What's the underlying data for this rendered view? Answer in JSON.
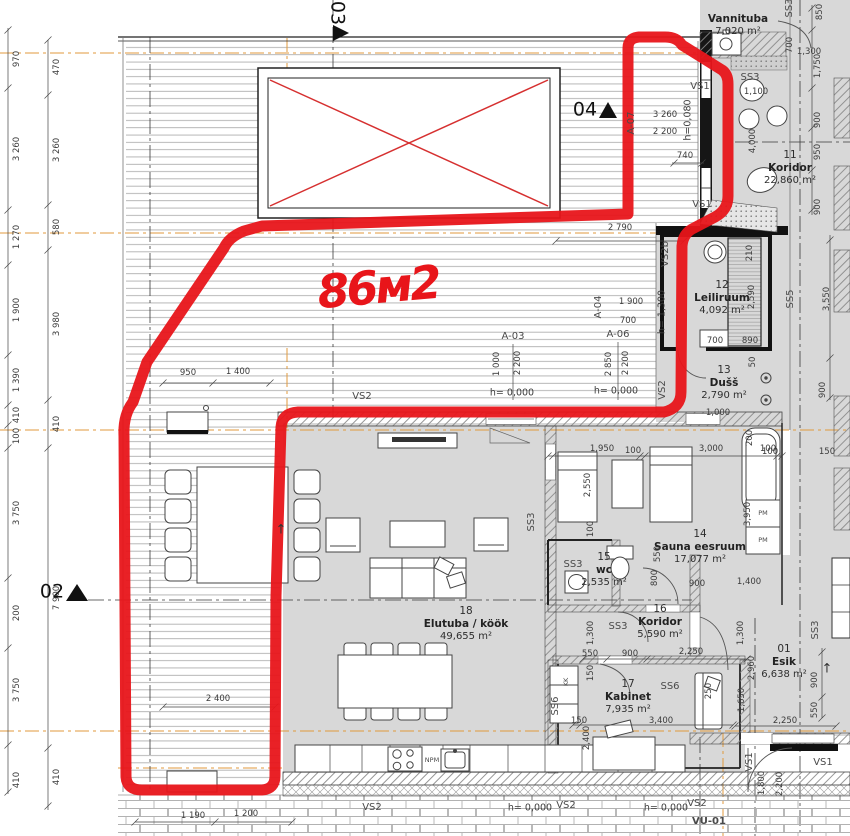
{
  "annotation": {
    "text": "86м2",
    "x": 378,
    "y": 287,
    "rot": -5,
    "size": 46,
    "color": "#e8151a"
  },
  "rooms": [
    {
      "num": "",
      "name": "Vannituba",
      "area": "7,020 m²",
      "x": 738,
      "y": 19
    },
    {
      "num": "11",
      "name": "Koridor",
      "area": "22,860 m²",
      "x": 790,
      "y": 168
    },
    {
      "num": "12",
      "name": "Leiliruum",
      "area": "4,092 m²",
      "x": 722,
      "y": 298
    },
    {
      "num": "13",
      "name": "Dušš",
      "area": "2,790 m²",
      "x": 724,
      "y": 383
    },
    {
      "num": "14",
      "name": "Sauna eesruum",
      "area": "17,077 m²",
      "x": 700,
      "y": 547
    },
    {
      "num": "15",
      "name": "wc",
      "area": "2,535 m²",
      "x": 604,
      "y": 570
    },
    {
      "num": "16",
      "name": "Koridor",
      "area": "5,590 m²",
      "x": 660,
      "y": 622
    },
    {
      "num": "17",
      "name": "Kabinet",
      "area": "7,935 m²",
      "x": 628,
      "y": 697
    },
    {
      "num": "18",
      "name": "Elutuba / köök",
      "area": "49,655 m²",
      "x": 466,
      "y": 624
    },
    {
      "num": "01",
      "name": "Esik",
      "area": "6,638 m²",
      "x": 784,
      "y": 662
    }
  ],
  "section_markers": [
    {
      "label": "02",
      "x": 52,
      "y": 592,
      "rot": 0
    },
    {
      "label": "03",
      "x": 337,
      "y": 13,
      "rot": 90
    },
    {
      "label": "04",
      "x": 585,
      "y": 110,
      "rot": 0
    }
  ],
  "wall_tags": [
    {
      "t": "VS1",
      "x": 700,
      "y": 87
    },
    {
      "t": "VS1",
      "x": 702,
      "y": 205
    },
    {
      "t": "VS2b",
      "x": 666,
      "y": 254,
      "r": -90
    },
    {
      "t": "VS2",
      "x": 663,
      "y": 390,
      "r": -90
    },
    {
      "t": "VS2",
      "x": 362,
      "y": 397
    },
    {
      "t": "VS2",
      "x": 372,
      "y": 808
    },
    {
      "t": "VS2",
      "x": 566,
      "y": 806
    },
    {
      "t": "VS2",
      "x": 697,
      "y": 804
    },
    {
      "t": "VS1",
      "x": 750,
      "y": 762,
      "r": -90
    },
    {
      "t": "VS1",
      "x": 823,
      "y": 763
    },
    {
      "t": "SS3",
      "x": 750,
      "y": 78
    },
    {
      "t": "SS3",
      "x": 790,
      "y": 8,
      "r": -90
    },
    {
      "t": "SS3",
      "x": 573,
      "y": 565
    },
    {
      "t": "SS3",
      "x": 618,
      "y": 627
    },
    {
      "t": "SS3",
      "x": 816,
      "y": 630,
      "r": -90
    },
    {
      "t": "SS3",
      "x": 532,
      "y": 522,
      "r": -90
    },
    {
      "t": "SS5",
      "x": 791,
      "y": 299,
      "r": -90
    },
    {
      "t": "SS6",
      "x": 670,
      "y": 687
    },
    {
      "t": "SS6",
      "x": 556,
      "y": 706,
      "r": -90
    },
    {
      "t": "KK",
      "x": 566,
      "y": 682,
      "r": -90,
      "s": 6.5
    },
    {
      "t": "PM",
      "x": 763,
      "y": 513,
      "s": 6.5
    },
    {
      "t": "PM",
      "x": 763,
      "y": 540,
      "s": 6.5
    },
    {
      "t": "NPM",
      "x": 432,
      "y": 760,
      "s": 6.5
    },
    {
      "t": "VU-01",
      "x": 709,
      "y": 822,
      "s": 10,
      "w": 700
    },
    {
      "t": "A-07",
      "x": 632,
      "y": 123,
      "r": -90
    },
    {
      "t": "A-03",
      "x": 513,
      "y": 337
    },
    {
      "t": "A-04",
      "x": 599,
      "y": 307,
      "r": -90
    },
    {
      "t": "A-06",
      "x": 618,
      "y": 335
    }
  ],
  "levels": [
    {
      "t": "h= 0,000",
      "x": 512,
      "y": 393
    },
    {
      "t": "h= 0,000",
      "x": 616,
      "y": 391
    },
    {
      "t": "h= 1,300",
      "x": 662,
      "y": 312,
      "r": -90
    },
    {
      "t": "h=0,080",
      "x": 688,
      "y": 120,
      "r": -90
    },
    {
      "t": "h= 0,000",
      "x": 530,
      "y": 808
    },
    {
      "t": "h= 0,000",
      "x": 666,
      "y": 808
    }
  ],
  "dimensions": [
    {
      "t": "970",
      "x": 17,
      "y": 59,
      "r": -90
    },
    {
      "t": "3 260",
      "x": 17,
      "y": 149,
      "r": -90
    },
    {
      "t": "1 270",
      "x": 17,
      "y": 237,
      "r": -90
    },
    {
      "t": "1 900",
      "x": 17,
      "y": 310,
      "r": -90
    },
    {
      "t": "1 390",
      "x": 17,
      "y": 380,
      "r": -90
    },
    {
      "t": "410",
      "x": 17,
      "y": 415,
      "r": -90
    },
    {
      "t": "100",
      "x": 17,
      "y": 436,
      "r": -90
    },
    {
      "t": "3 750",
      "x": 17,
      "y": 513,
      "r": -90
    },
    {
      "t": "200",
      "x": 17,
      "y": 613,
      "r": -90
    },
    {
      "t": "3 750",
      "x": 17,
      "y": 690,
      "r": -90
    },
    {
      "t": "410",
      "x": 17,
      "y": 780,
      "r": -90
    },
    {
      "t": "470",
      "x": 57,
      "y": 67,
      "r": -90
    },
    {
      "t": "3 260",
      "x": 57,
      "y": 150,
      "r": -90
    },
    {
      "t": "580",
      "x": 57,
      "y": 227,
      "r": -90
    },
    {
      "t": "3 980",
      "x": 57,
      "y": 324,
      "r": -90
    },
    {
      "t": "410",
      "x": 57,
      "y": 424,
      "r": -90
    },
    {
      "t": "7 900",
      "x": 57,
      "y": 598,
      "r": -90
    },
    {
      "t": "410",
      "x": 57,
      "y": 777,
      "r": -90
    },
    {
      "t": "950",
      "x": 188,
      "y": 373
    },
    {
      "t": "1 400",
      "x": 238,
      "y": 372
    },
    {
      "t": "2 400",
      "x": 218,
      "y": 699
    },
    {
      "t": "1 190",
      "x": 193,
      "y": 816
    },
    {
      "t": "1 200",
      "x": 246,
      "y": 814
    },
    {
      "t": "2 790",
      "x": 620,
      "y": 228
    },
    {
      "t": "3 260",
      "x": 665,
      "y": 115
    },
    {
      "t": "2 200",
      "x": 665,
      "y": 132
    },
    {
      "t": "740",
      "x": 685,
      "y": 156
    },
    {
      "t": "1 000",
      "x": 497,
      "y": 364,
      "r": -90
    },
    {
      "t": "2 200",
      "x": 518,
      "y": 363,
      "r": -90
    },
    {
      "t": "1 900",
      "x": 631,
      "y": 302
    },
    {
      "t": "700",
      "x": 628,
      "y": 321
    },
    {
      "t": "2 850",
      "x": 609,
      "y": 364,
      "r": -90
    },
    {
      "t": "2 200",
      "x": 626,
      "y": 363,
      "r": -90
    },
    {
      "t": "210",
      "x": 750,
      "y": 253,
      "r": -90
    },
    {
      "t": "2,590",
      "x": 752,
      "y": 297,
      "r": -90
    },
    {
      "t": "700",
      "x": 715,
      "y": 341
    },
    {
      "t": "890",
      "x": 750,
      "y": 341
    },
    {
      "t": "1,000",
      "x": 718,
      "y": 413
    },
    {
      "t": "50",
      "x": 753,
      "y": 362,
      "r": -90
    },
    {
      "t": "4,000",
      "x": 753,
      "y": 141,
      "r": -90
    },
    {
      "t": "1,100",
      "x": 756,
      "y": 92
    },
    {
      "t": "850",
      "x": 820,
      "y": 12,
      "r": -90
    },
    {
      "t": "700",
      "x": 790,
      "y": 45,
      "r": -90
    },
    {
      "t": "1,300",
      "x": 809,
      "y": 52
    },
    {
      "t": "1,750",
      "x": 818,
      "y": 66,
      "r": -90
    },
    {
      "t": "900",
      "x": 818,
      "y": 120,
      "r": -90
    },
    {
      "t": "950",
      "x": 818,
      "y": 152,
      "r": -90
    },
    {
      "t": "900",
      "x": 818,
      "y": 207,
      "r": -90
    },
    {
      "t": "3,550",
      "x": 827,
      "y": 299,
      "r": -90
    },
    {
      "t": "900",
      "x": 823,
      "y": 390,
      "r": -90
    },
    {
      "t": "150",
      "x": 827,
      "y": 452
    },
    {
      "t": "100",
      "x": 768,
      "y": 449
    },
    {
      "t": "200",
      "x": 750,
      "y": 438,
      "r": -90
    },
    {
      "t": "3,950",
      "x": 748,
      "y": 514,
      "r": -90
    },
    {
      "t": "1,950",
      "x": 602,
      "y": 449
    },
    {
      "t": "100",
      "x": 633,
      "y": 451
    },
    {
      "t": "3,000",
      "x": 711,
      "y": 449
    },
    {
      "t": "100",
      "x": 770,
      "y": 452
    },
    {
      "t": "2,550",
      "x": 588,
      "y": 485,
      "r": -90
    },
    {
      "t": "100",
      "x": 591,
      "y": 529,
      "r": -90
    },
    {
      "t": "550",
      "x": 658,
      "y": 554,
      "r": -90
    },
    {
      "t": "800",
      "x": 655,
      "y": 578,
      "r": -90
    },
    {
      "t": "900",
      "x": 697,
      "y": 584
    },
    {
      "t": "1,400",
      "x": 749,
      "y": 582
    },
    {
      "t": "550",
      "x": 590,
      "y": 654
    },
    {
      "t": "900",
      "x": 630,
      "y": 654
    },
    {
      "t": "2,250",
      "x": 691,
      "y": 652
    },
    {
      "t": "1,300",
      "x": 591,
      "y": 633,
      "r": -90
    },
    {
      "t": "1,300",
      "x": 741,
      "y": 633,
      "r": -90
    },
    {
      "t": "150",
      "x": 591,
      "y": 673,
      "r": -90
    },
    {
      "t": "3,400",
      "x": 661,
      "y": 721
    },
    {
      "t": "150",
      "x": 579,
      "y": 721
    },
    {
      "t": "2,400",
      "x": 587,
      "y": 738,
      "r": -90
    },
    {
      "t": "2,960",
      "x": 752,
      "y": 668,
      "r": -90
    },
    {
      "t": "1,650",
      "x": 742,
      "y": 700,
      "r": -90
    },
    {
      "t": "250",
      "x": 709,
      "y": 691,
      "r": -90
    },
    {
      "t": "900",
      "x": 815,
      "y": 680,
      "r": -90
    },
    {
      "t": "550",
      "x": 815,
      "y": 710,
      "r": -90
    },
    {
      "t": "2,250",
      "x": 785,
      "y": 721
    },
    {
      "t": "1,800",
      "x": 762,
      "y": 783,
      "r": -90
    },
    {
      "t": "2,200",
      "x": 780,
      "y": 784,
      "r": -90
    }
  ],
  "arrows": [
    {
      "t": "↑",
      "x": 281,
      "y": 530
    },
    {
      "t": "↑",
      "x": 827,
      "y": 669
    }
  ],
  "colors": {
    "outline_red": "#e8151a",
    "floor_gray": "#d8d8d8",
    "grid_orange": "#e09a3c"
  }
}
